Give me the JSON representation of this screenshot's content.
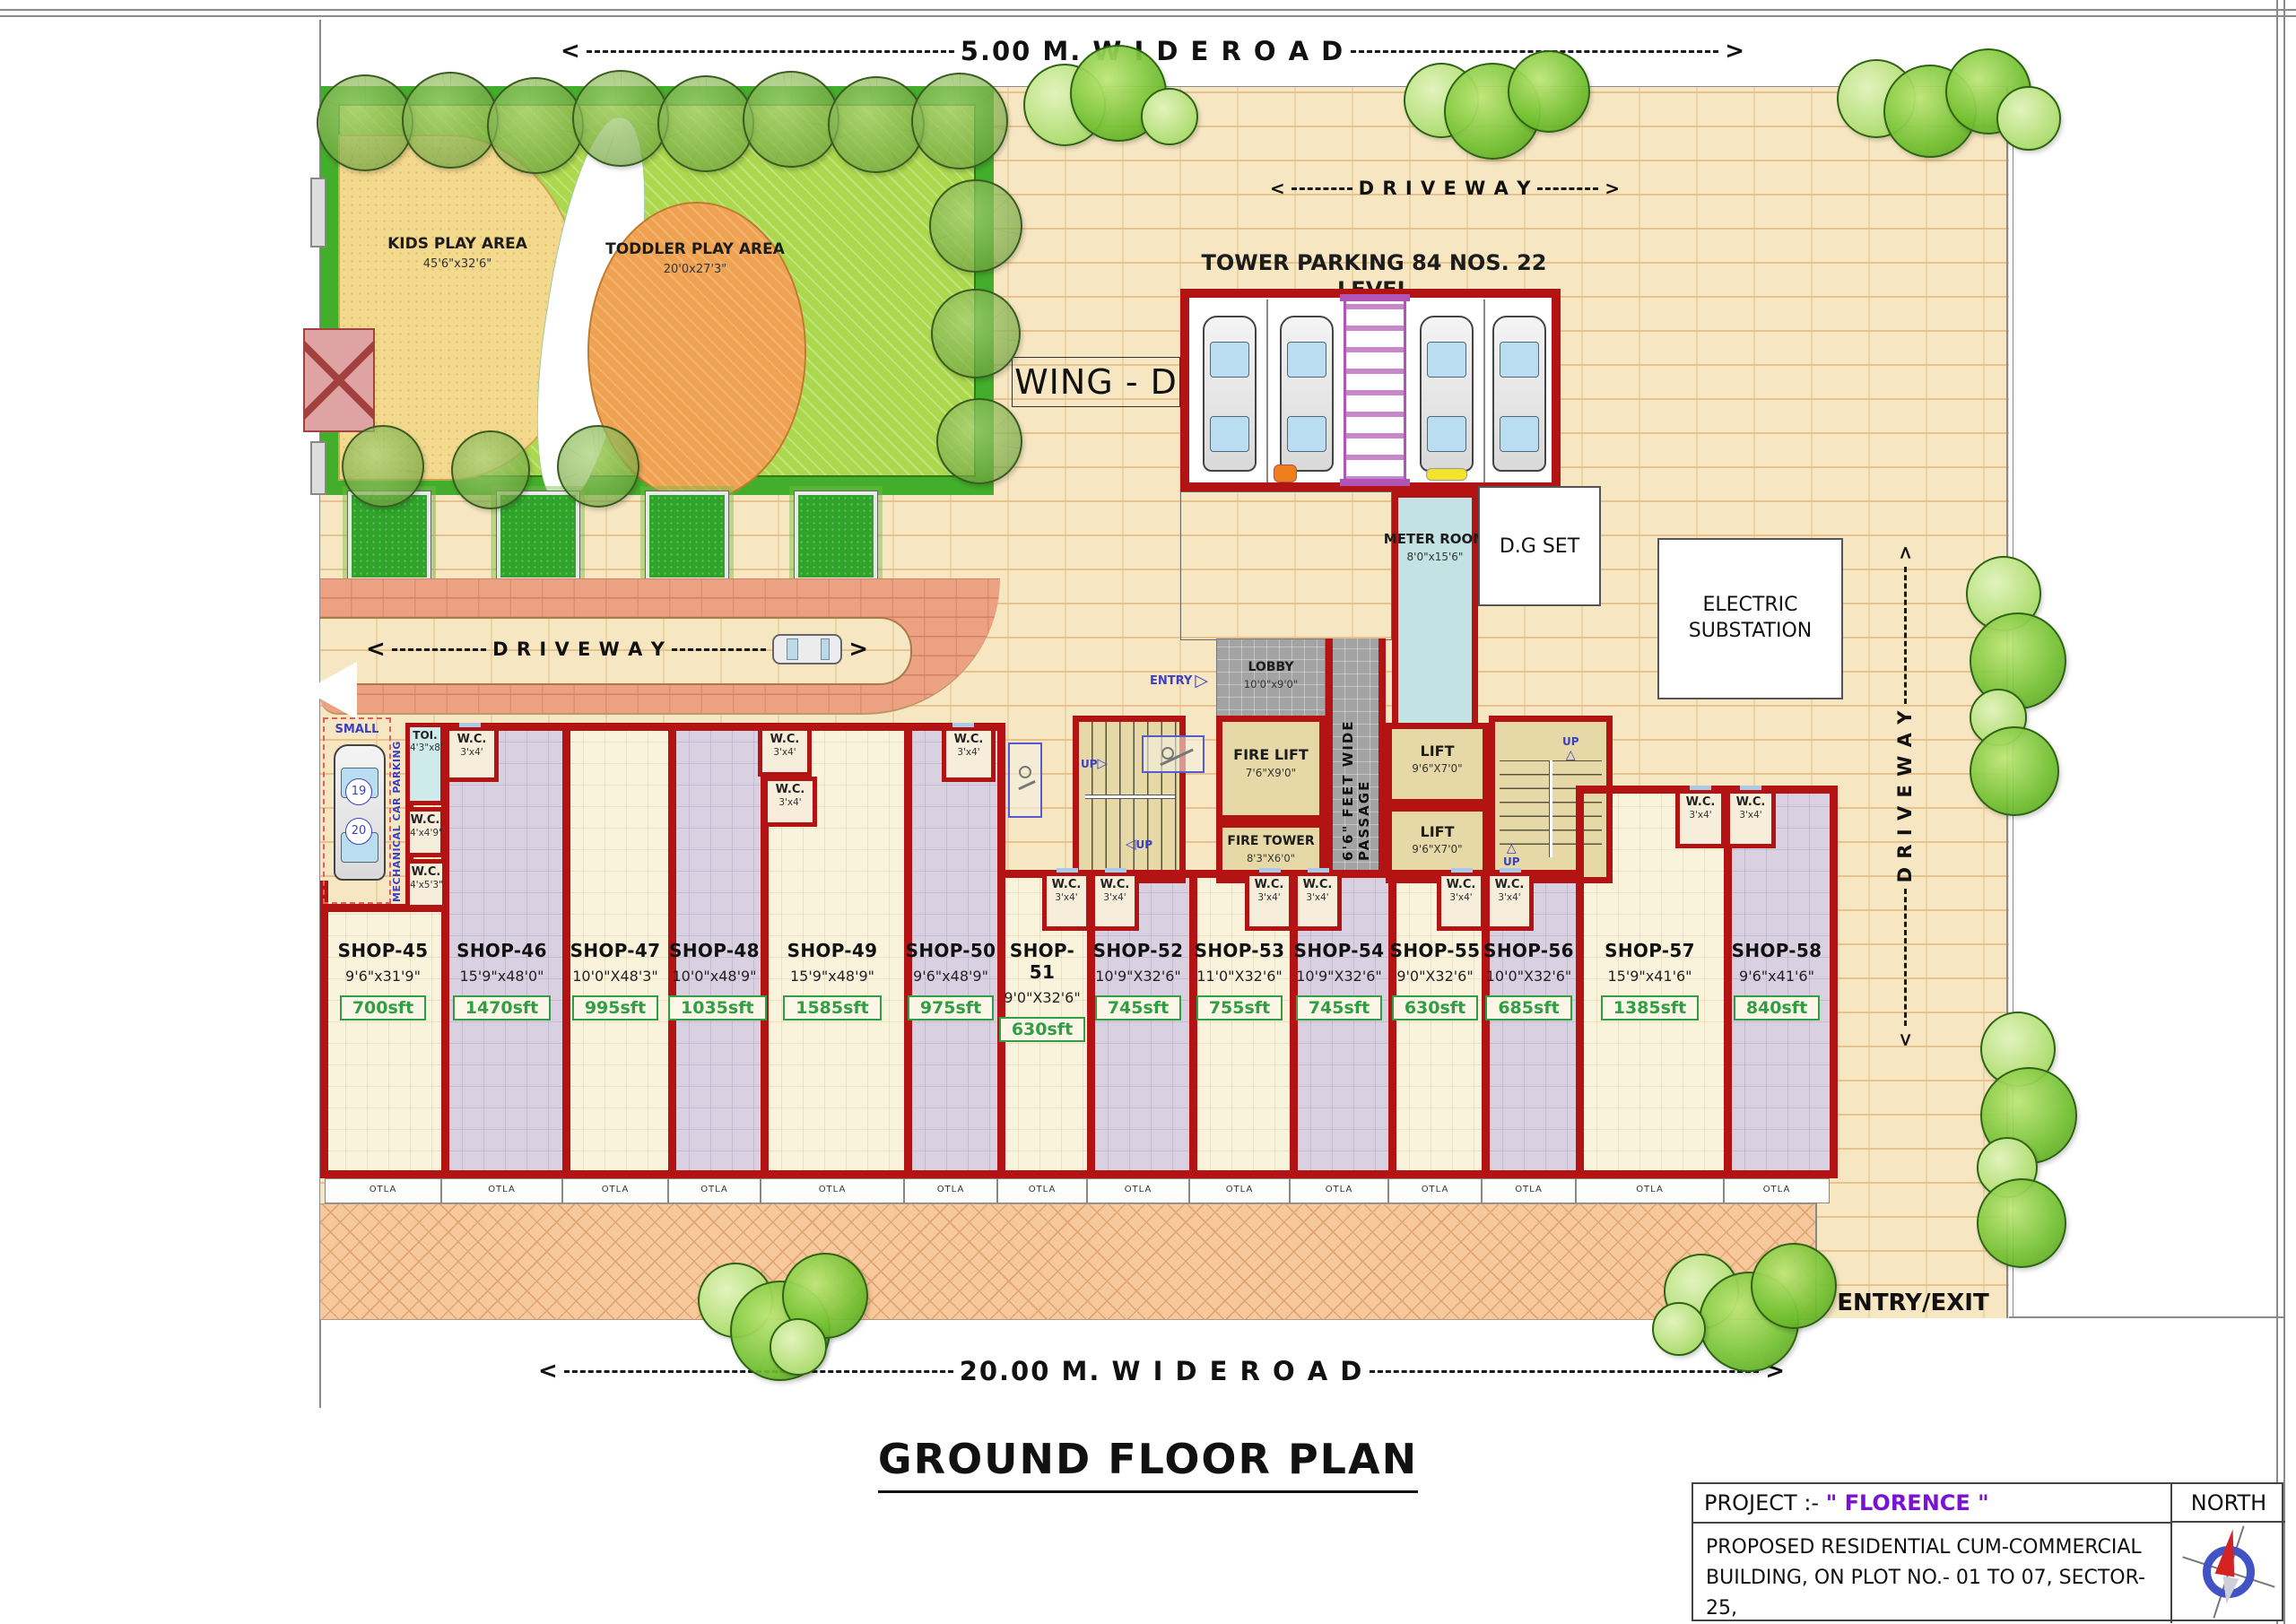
{
  "page": {
    "title": "GROUND FLOOR PLAN"
  },
  "colors": {
    "wall_red": "#b31313",
    "shop_cream": "#faf3dc",
    "shop_lavender": "#d9d1e1",
    "plot_tan": "#f6e7c2",
    "driveway_salmon": "#eca183",
    "pavement_orange": "#f6c89b",
    "lawn_green": "#abd84d",
    "hedge_green": "#43ad2c",
    "sand_yellow": "#f3d98e",
    "toddler_orange": "#efa352",
    "meter_cyan": "#c2e2e4",
    "passage_gray": "#a3a3a3",
    "area_green": "#2f9e44",
    "project_purple": "#7a12d4",
    "annotation_blue": "#3b3fc4"
  },
  "roads": {
    "top": "5.00 M. W I D E  R O A D",
    "bottom": "20.00 M. W I D E  R O A D",
    "right": "D R I V E  W A Y",
    "driveway": "D R I V E  W A Y",
    "driveway_top": "D R I V E  W A Y",
    "arrow_left": "<",
    "arrow_right": ">"
  },
  "labels": {
    "wing": "WING - D",
    "tower_parking": "TOWER PARKING 84 NOS. 22 LEVEL",
    "entry_exit": "ENTRY/EXIT",
    "entry": "ENTRY",
    "entry_arrow": "▷",
    "up": "UP",
    "up_arrow": "△",
    "up_arrow_right": "▷",
    "up_arrow_left": "◁",
    "otla": "OTLA",
    "small": "SMALL",
    "mech_parking": "MECHANICAL CAR PARKING",
    "slot19": "19",
    "slot20": "20"
  },
  "garden": {
    "kids": {
      "name": "KIDS PLAY AREA",
      "dims": "45'6\"x32'6\""
    },
    "toddler": {
      "name": "TODDLER PLAY AREA",
      "dims": "20'0x27'3\""
    }
  },
  "rooms": {
    "meter": {
      "name": "METER ROOM",
      "dims": "8'0\"x15'6\""
    },
    "dg": {
      "name": "D.G SET"
    },
    "substation": {
      "name": "ELECTRIC SUBSTATION"
    },
    "lobby": {
      "name": "LOBBY",
      "dims": "10'0\"x9'0\""
    },
    "fire_lift": {
      "name": "FIRE LIFT",
      "dims": "7'6\"X9'0\""
    },
    "fire_tower": {
      "name": "FIRE TOWER",
      "dims": "8'3\"X6'0\""
    },
    "lift": {
      "name": "LIFT",
      "dims": "9'6\"X7'0\""
    },
    "passage": {
      "name": "6'6\" FEET WIDE PASSAGE"
    },
    "toilet": {
      "name": "TOI.",
      "dims": "4'3\"x8'"
    },
    "wc": {
      "name": "W.C.",
      "s1": "3'x4'",
      "s2": "4'x4'9\"",
      "s3": "4'x5'3\""
    }
  },
  "shops": [
    {
      "name": "SHOP-45",
      "dims": "9'6\"x31'9\"",
      "area": "700sft"
    },
    {
      "name": "SHOP-46",
      "dims": "15'9\"x48'0\"",
      "area": "1470sft"
    },
    {
      "name": "SHOP-47",
      "dims": "10'0\"X48'3\"",
      "area": "995sft"
    },
    {
      "name": "SHOP-48",
      "dims": "10'0\"x48'9\"",
      "area": "1035sft"
    },
    {
      "name": "SHOP-49",
      "dims": "15'9\"x48'9\"",
      "area": "1585sft"
    },
    {
      "name": "SHOP-50",
      "dims": "9'6\"x48'9\"",
      "area": "975sft"
    },
    {
      "name": "SHOP-51",
      "dims": "9'0\"X32'6\"",
      "area": "630sft"
    },
    {
      "name": "SHOP-52",
      "dims": "10'9\"X32'6\"",
      "area": "745sft"
    },
    {
      "name": "SHOP-53",
      "dims": "11'0\"X32'6\"",
      "area": "755sft"
    },
    {
      "name": "SHOP-54",
      "dims": "10'9\"X32'6\"",
      "area": "745sft"
    },
    {
      "name": "SHOP-55",
      "dims": "9'0\"X32'6\"",
      "area": "630sft"
    },
    {
      "name": "SHOP-56",
      "dims": "10'0\"X32'6\"",
      "area": "685sft"
    },
    {
      "name": "SHOP-57",
      "dims": "15'9\"x41'6\"",
      "area": "1385sft"
    },
    {
      "name": "SHOP-58",
      "dims": "9'6\"x41'6\"",
      "area": "840sft"
    }
  ],
  "project": {
    "label": "PROJECT :-",
    "name": "\" FLORENCE \"",
    "north": "NORTH",
    "line1": "PROPOSED RESIDENTIAL CUM-COMMERCIAL",
    "line2": "BUILDING, ON PLOT NO.- 01 TO 07, SECTOR-25,",
    "line3": "KAMOTHE, NAVI MUMBAI."
  }
}
